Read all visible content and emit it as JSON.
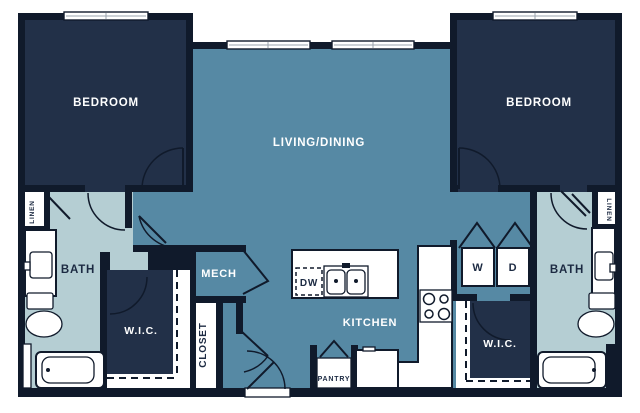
{
  "plan": {
    "type": "apartment-floor-plan",
    "bedrooms": 2,
    "bathrooms": 2
  },
  "colors": {
    "wall": "#101A2B",
    "bedroom_fill": "#223048",
    "living_fill": "#5689A4",
    "bath_fill": "#B5CED3",
    "floor_white": "#FFFFFF",
    "label_light": "#FFFFFF",
    "label_dark": "#1C2A42"
  },
  "rooms": {
    "bedroom_left": "BEDROOM",
    "bedroom_right": "BEDROOM",
    "living_dining": "LIVING/DINING",
    "bath_left": "BATH",
    "bath_right": "BATH",
    "wic_left": "W.I.C.",
    "wic_right": "W.I.C.",
    "mech": "MECH",
    "kitchen": "KITCHEN",
    "closet": "CLOSET",
    "pantry": "PANTRY",
    "linen_left": "LINEN",
    "linen_right": "LINEN"
  },
  "appliances": {
    "dishwasher": "DW",
    "washer": "W",
    "dryer": "D"
  }
}
